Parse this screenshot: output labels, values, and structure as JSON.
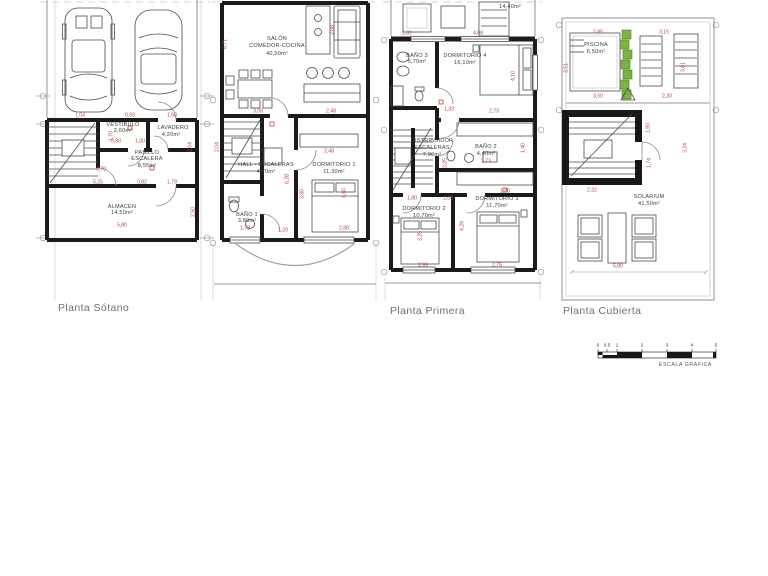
{
  "plans": {
    "sotano": {
      "label": "Planta Sótano"
    },
    "primera": {
      "label": "Planta Primera"
    },
    "cubierta": {
      "label": "Planta Cubierta"
    }
  },
  "scalebar": {
    "label": "ESCALA GRÁFICA"
  },
  "annotations": [
    {
      "t": "VESTIBULO",
      "x": 123,
      "y": 126,
      "c": "room"
    },
    {
      "t": "2,60m²",
      "x": 123,
      "y": 132,
      "c": "room"
    },
    {
      "t": "LAVADERO",
      "x": 173,
      "y": 129,
      "c": "room"
    },
    {
      "t": "4,20m²",
      "x": 171,
      "y": 136,
      "c": "room"
    },
    {
      "t": "PASILLO",
      "x": 147,
      "y": 154,
      "c": "room"
    },
    {
      "t": "ESCALERA",
      "x": 147,
      "y": 160,
      "c": "room"
    },
    {
      "t": "8,55m²",
      "x": 147,
      "y": 167,
      "c": "room"
    },
    {
      "t": "ALMACÉN",
      "x": 122,
      "y": 208,
      "c": "room"
    },
    {
      "t": "14,50m²",
      "x": 122,
      "y": 214,
      "c": "room"
    },
    {
      "t": "1,04",
      "x": 80,
      "y": 116,
      "c": "dim"
    },
    {
      "t": "0,93",
      "x": 130,
      "y": 116,
      "c": "dim"
    },
    {
      "t": "1,60",
      "x": 172,
      "y": 116,
      "c": "dim"
    },
    {
      "t": "0,88",
      "x": 116,
      "y": 142,
      "c": "dim"
    },
    {
      "t": "1,00",
      "x": 140,
      "y": 142,
      "c": "dim"
    },
    {
      "t": "1,70",
      "x": 112,
      "y": 136,
      "c": "dim",
      "r": -90
    },
    {
      "t": "2,04",
      "x": 191,
      "y": 147,
      "c": "dim",
      "r": -90
    },
    {
      "t": "4,70",
      "x": 101,
      "y": 170,
      "c": "dim"
    },
    {
      "t": "5,25",
      "x": 98,
      "y": 183,
      "c": "dim"
    },
    {
      "t": "0,82",
      "x": 142,
      "y": 183,
      "c": "dim"
    },
    {
      "t": "1,79",
      "x": 172,
      "y": 183,
      "c": "dim"
    },
    {
      "t": "2,50",
      "x": 194,
      "y": 212,
      "c": "dim",
      "r": -90
    },
    {
      "t": "5,80",
      "x": 122,
      "y": 226,
      "c": "dim"
    },
    {
      "t": "SALÓN",
      "x": 277,
      "y": 40,
      "c": "room"
    },
    {
      "t": "COMEDOR-COCINA",
      "x": 277,
      "y": 47,
      "c": "room"
    },
    {
      "t": "40,50m²",
      "x": 277,
      "y": 55,
      "c": "room"
    },
    {
      "t": "6,71",
      "x": 226,
      "y": 44,
      "c": "dim",
      "r": -90
    },
    {
      "t": "2,08",
      "x": 333,
      "y": 30,
      "c": "dim",
      "r": -90
    },
    {
      "t": "3,08",
      "x": 258,
      "y": 112,
      "c": "dim"
    },
    {
      "t": "2,48",
      "x": 331,
      "y": 112,
      "c": "dim"
    },
    {
      "t": "HALL - ESCALERAS",
      "x": 266,
      "y": 166,
      "c": "room"
    },
    {
      "t": "4,70m²",
      "x": 266,
      "y": 173,
      "c": "room"
    },
    {
      "t": "2,48",
      "x": 329,
      "y": 152,
      "c": "dim"
    },
    {
      "t": "DORMITORIO 1",
      "x": 334,
      "y": 166,
      "c": "room"
    },
    {
      "t": "11,30m²",
      "x": 334,
      "y": 173,
      "c": "room"
    },
    {
      "t": "6,28",
      "x": 288,
      "y": 179,
      "c": "dim",
      "r": -90
    },
    {
      "t": "3,80",
      "x": 303,
      "y": 194,
      "c": "dim",
      "r": -90
    },
    {
      "t": "4,60",
      "x": 345,
      "y": 193,
      "c": "dim",
      "r": -90
    },
    {
      "t": "2,04",
      "x": 218,
      "y": 147,
      "c": "dim",
      "r": -90
    },
    {
      "t": "BAÑO 1",
      "x": 247,
      "y": 216,
      "c": "room"
    },
    {
      "t": "3,80m²",
      "x": 247,
      "y": 222,
      "c": "room"
    },
    {
      "t": "1,73",
      "x": 245,
      "y": 229,
      "c": "dim"
    },
    {
      "t": "1,20",
      "x": 283,
      "y": 231,
      "c": "dim"
    },
    {
      "t": "2,88",
      "x": 344,
      "y": 229,
      "c": "dim"
    },
    {
      "t": "14,40m²",
      "x": 510,
      "y": 8,
      "c": "room"
    },
    {
      "t": "1,81",
      "x": 407,
      "y": 34,
      "c": "dim"
    },
    {
      "t": "4,08",
      "x": 478,
      "y": 34,
      "c": "dim"
    },
    {
      "t": "BAÑO 3",
      "x": 417,
      "y": 57,
      "c": "room"
    },
    {
      "t": "5,70m²",
      "x": 417,
      "y": 63,
      "c": "room"
    },
    {
      "t": "DORMITORIO 4",
      "x": 465,
      "y": 57,
      "c": "room"
    },
    {
      "t": "16,10m²",
      "x": 465,
      "y": 64,
      "c": "room"
    },
    {
      "t": "4,10",
      "x": 514,
      "y": 76,
      "c": "dim",
      "r": -90
    },
    {
      "t": "2,73",
      "x": 494,
      "y": 112,
      "c": "dim"
    },
    {
      "t": "1,32",
      "x": 449,
      "y": 110,
      "c": "dim"
    },
    {
      "t": "DISTRIBUIDOR",
      "x": 432,
      "y": 142,
      "c": "room"
    },
    {
      "t": "ESCALERAS",
      "x": 432,
      "y": 149,
      "c": "room"
    },
    {
      "t": "7,90m²",
      "x": 432,
      "y": 156,
      "c": "room"
    },
    {
      "t": "BAÑO 2",
      "x": 486,
      "y": 148,
      "c": "room"
    },
    {
      "t": "4,40m²",
      "x": 486,
      "y": 155,
      "c": "room"
    },
    {
      "t": "2,73",
      "x": 486,
      "y": 162,
      "c": "dim"
    },
    {
      "t": "1,40",
      "x": 524,
      "y": 148,
      "c": "dim",
      "r": -90
    },
    {
      "t": "3,25",
      "x": 446,
      "y": 163,
      "c": "dim",
      "r": -90
    },
    {
      "t": "1,80",
      "x": 412,
      "y": 199,
      "c": "dim"
    },
    {
      "t": "1,03",
      "x": 448,
      "y": 199,
      "c": "dim"
    },
    {
      "t": "1,80",
      "x": 505,
      "y": 192,
      "c": "dim"
    },
    {
      "t": "DORMITORIO 2",
      "x": 424,
      "y": 210,
      "c": "room"
    },
    {
      "t": "10,70m²",
      "x": 424,
      "y": 217,
      "c": "room"
    },
    {
      "t": "DORMITORIO 3",
      "x": 497,
      "y": 200,
      "c": "room"
    },
    {
      "t": "11,70m²",
      "x": 497,
      "y": 207,
      "c": "room"
    },
    {
      "t": "3,25",
      "x": 421,
      "y": 236,
      "c": "dim",
      "r": -90
    },
    {
      "t": "4,29",
      "x": 463,
      "y": 226,
      "c": "dim",
      "r": -90
    },
    {
      "t": "2,99",
      "x": 423,
      "y": 266,
      "c": "dim"
    },
    {
      "t": "2,75",
      "x": 497,
      "y": 266,
      "c": "dim"
    },
    {
      "t": "PISCINA",
      "x": 596,
      "y": 46,
      "c": "room"
    },
    {
      "t": "6,50m²",
      "x": 596,
      "y": 53,
      "c": "room"
    },
    {
      "t": "2,85",
      "x": 598,
      "y": 33,
      "c": "dim"
    },
    {
      "t": "3,15",
      "x": 664,
      "y": 33,
      "c": "dim"
    },
    {
      "t": "3,51",
      "x": 567,
      "y": 68,
      "c": "dim",
      "r": -90
    },
    {
      "t": "3,61",
      "x": 684,
      "y": 67,
      "c": "dim",
      "r": -90
    },
    {
      "t": "3,50",
      "x": 598,
      "y": 97,
      "c": "dim"
    },
    {
      "t": "2,30",
      "x": 667,
      "y": 97,
      "c": "dim"
    },
    {
      "t": "1,90",
      "x": 649,
      "y": 128,
      "c": "dim",
      "r": -90
    },
    {
      "t": "1,74",
      "x": 650,
      "y": 163,
      "c": "dim",
      "r": -90
    },
    {
      "t": "3,24",
      "x": 686,
      "y": 148,
      "c": "dim",
      "r": -90
    },
    {
      "t": "2,32",
      "x": 592,
      "y": 191,
      "c": "dim"
    },
    {
      "t": "SOLARIUM",
      "x": 649,
      "y": 198,
      "c": "room"
    },
    {
      "t": "41,50m²",
      "x": 649,
      "y": 205,
      "c": "room"
    },
    {
      "t": "5,80",
      "x": 618,
      "y": 267,
      "c": "dim"
    },
    {
      "t": "0",
      "x": 598,
      "y": 347,
      "c": "tick"
    },
    {
      "t": "0.5",
      "x": 607,
      "y": 347,
      "c": "tick"
    },
    {
      "t": "1",
      "x": 617,
      "y": 347,
      "c": "tick"
    },
    {
      "t": "2",
      "x": 642,
      "y": 347,
      "c": "tick"
    },
    {
      "t": "3",
      "x": 667,
      "y": 347,
      "c": "tick"
    },
    {
      "t": "4",
      "x": 692,
      "y": 347,
      "c": "tick"
    },
    {
      "t": "5",
      "x": 716,
      "y": 347,
      "c": "tick"
    }
  ]
}
